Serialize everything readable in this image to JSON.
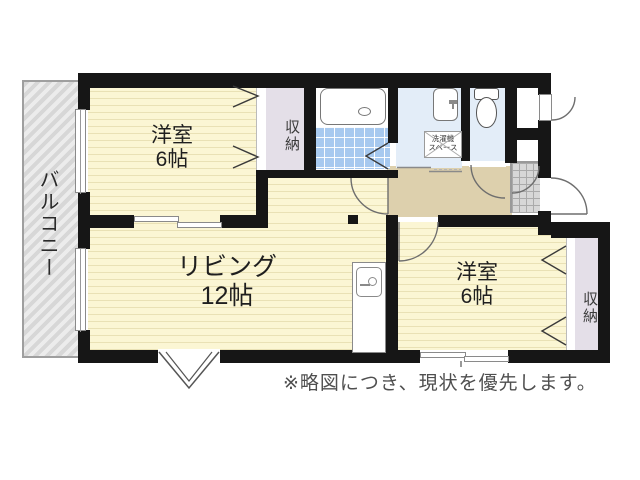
{
  "floorplan": {
    "balcony_label": "バルコニー",
    "rooms": {
      "bedroom_top": {
        "name": "洋室",
        "size": "6帖"
      },
      "living": {
        "name": "リビング",
        "size": "12帖"
      },
      "bedroom_right": {
        "name": "洋室",
        "size": "6帖"
      }
    },
    "closet_top_label": "収納",
    "closet_right_label": "収納",
    "laundry_space": {
      "line1": "洗濯機",
      "line2": "スペース"
    },
    "note": "※略図につき、現状を優先します。",
    "colors": {
      "wall": "#161616",
      "room_floor": "#fbf6d4",
      "room_stripe": "#e9e1b5",
      "hall_floor": "#ddd0ad",
      "closet": "#e4dfe8",
      "wet_area": "#e3edf8",
      "bath_tile": "#a7c9ef",
      "genkan_tile": "#d7d7d7",
      "balcony": "#d7d7d7"
    }
  }
}
